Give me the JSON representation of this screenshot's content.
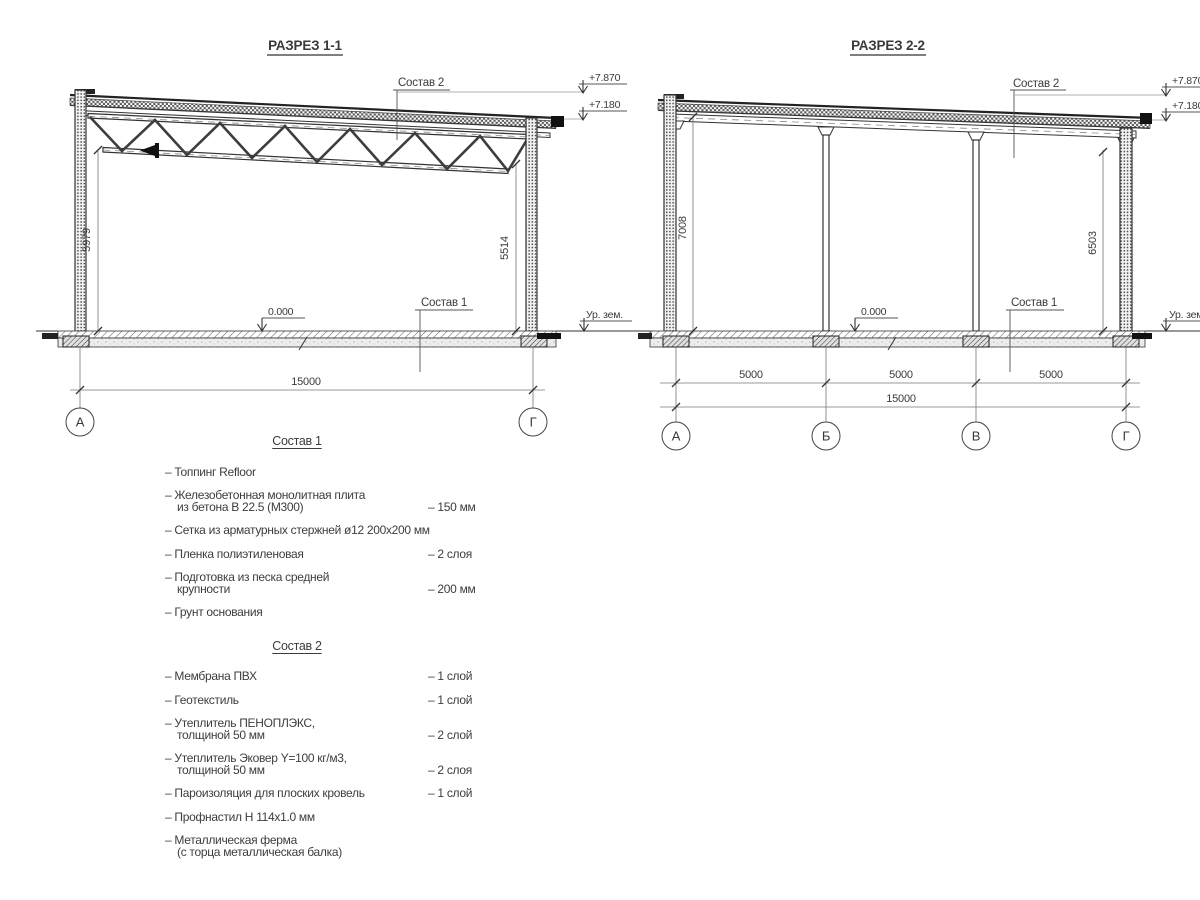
{
  "drawing": {
    "section1": {
      "title": "РАЗРЕЗ 1-1",
      "sostav2_label": "Состав 2",
      "sostav1_label": "Состав 1",
      "elev_top": "+7.870",
      "elev_low": "+7.180",
      "ground_label": "Ур. зем.",
      "level_zero": "0.000",
      "dim_left": "5979",
      "dim_right": "5514",
      "dim_span": "15000",
      "axis_left": "А",
      "axis_right": "Г"
    },
    "section2": {
      "title": "РАЗРЕЗ 2-2",
      "sostav2_label": "Состав 2",
      "sostav1_label": "Состав 1",
      "elev_top": "+7.870",
      "elev_low": "+7.180",
      "ground_label": "Ур. зем.",
      "level_zero": "0.000",
      "dim_left": "7008",
      "dim_right": "6503",
      "dim_spans": [
        "5000",
        "5000",
        "5000"
      ],
      "dim_total": "15000",
      "axes": [
        "А",
        "Б",
        "В",
        "Г"
      ]
    }
  },
  "lists": {
    "sostav1": {
      "heading": "Состав 1",
      "items": [
        {
          "line1": "– Топпинг Refloor",
          "line2": "",
          "value": ""
        },
        {
          "line1": "– Железобетонная  монолитная плита",
          "line2": "из бетона В 22.5 (М300)",
          "value": "– 150 мм"
        },
        {
          "line1": "– Сетка из арматурных стержней ø12 200x200 мм",
          "line2": "",
          "value": ""
        },
        {
          "line1": "– Пленка полиэтиленовая",
          "line2": "",
          "value": "– 2 слоя"
        },
        {
          "line1": "– Подготовка из песка средней",
          "line2": "крупности",
          "value": "– 200 мм"
        },
        {
          "line1": "– Грунт основания",
          "line2": "",
          "value": ""
        }
      ]
    },
    "sostav2": {
      "heading": "Состав 2",
      "items": [
        {
          "line1": "– Мембрана ПВХ",
          "line2": "",
          "value": "– 1 слой"
        },
        {
          "line1": "– Геотекстиль",
          "line2": "",
          "value": "– 1 слой"
        },
        {
          "line1": "– Утеплитель ПЕНОПЛЭКС,",
          "line2": "толщиной 50 мм",
          "value": "– 2 слой"
        },
        {
          "line1": "– Утеплитель Эковер Y=100 кг/м3,",
          "line2": "толщиной 50 мм",
          "value": "– 2 слоя"
        },
        {
          "line1": "– Пароизоляция для плоских кровель",
          "line2": "",
          "value": "– 1 слой"
        },
        {
          "line1": "– Профнастил Н 114x1.0 мм",
          "line2": "",
          "value": ""
        },
        {
          "line1": "– Металлическая ферма",
          "line2": "(с торца металлическая балка)",
          "value": ""
        }
      ]
    }
  }
}
